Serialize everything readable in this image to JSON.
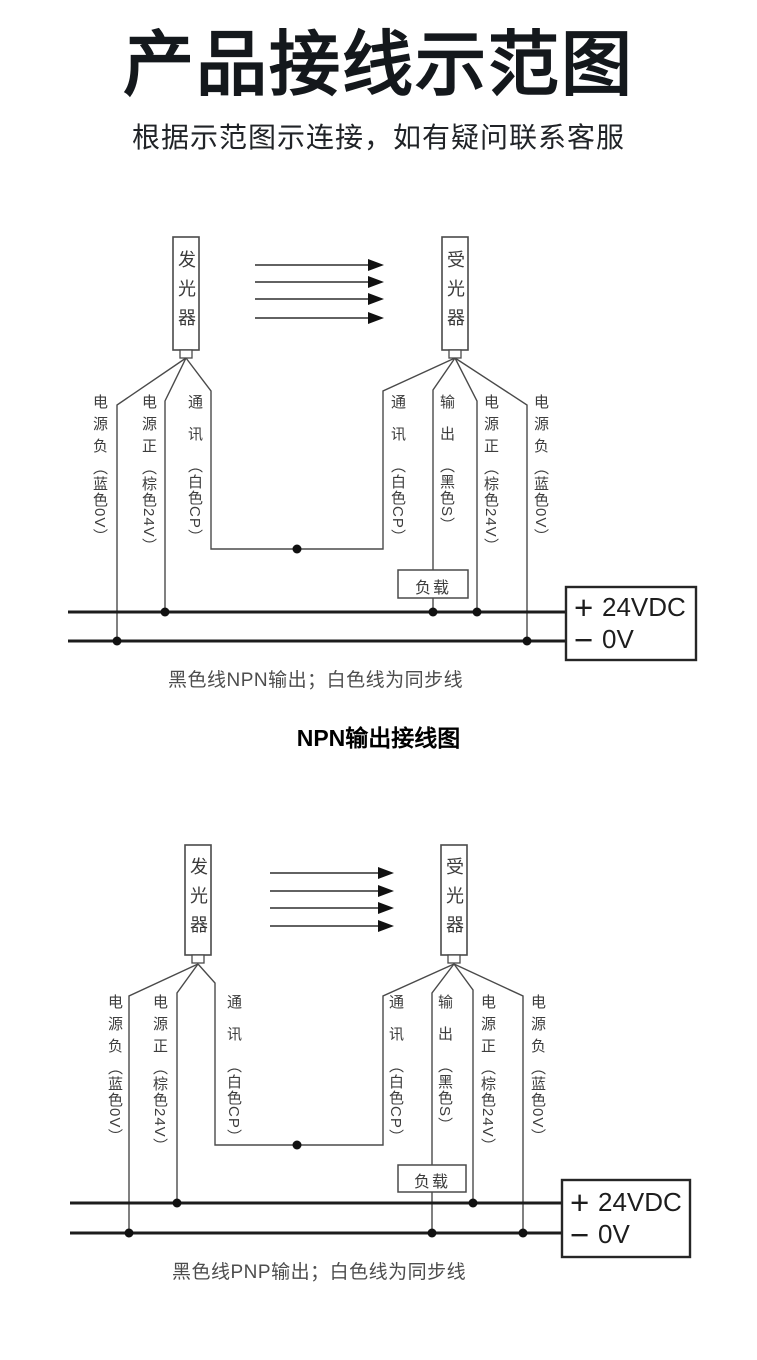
{
  "header": {
    "title": "产品接线示范图",
    "subtitle": "根据示范图示连接，如有疑问联系客服"
  },
  "diagrams": [
    {
      "emitter": "发光器",
      "receiver": "受光器",
      "left_wires": [
        {
          "name": "电源负",
          "detail": "（蓝色0V）"
        },
        {
          "name": "电源正",
          "detail": "（棕色24V）"
        },
        {
          "name": "通讯",
          "detail": "（白色CP）"
        }
      ],
      "right_wires": [
        {
          "name": "通讯",
          "detail": "（白色CP）"
        },
        {
          "name": "输出",
          "detail": "（黑色S）"
        },
        {
          "name": "电源正",
          "detail": "（棕色24V）"
        },
        {
          "name": "电源负",
          "detail": "（蓝色0V）"
        }
      ],
      "load": "负载",
      "psu": {
        "positive_sign": "+",
        "positive_label": "24VDC",
        "negative_sign": "−",
        "negative_label": "0V"
      },
      "caption": "黑色线NPN输出；白色线为同步线",
      "title": "NPN输出接线图"
    },
    {
      "emitter": "发光器",
      "receiver": "受光器",
      "left_wires": [
        {
          "name": "电源负",
          "detail": "（蓝色0V）"
        },
        {
          "name": "电源正",
          "detail": "（棕色24V）"
        },
        {
          "name": "通讯",
          "detail": "（白色CP）"
        }
      ],
      "right_wires": [
        {
          "name": "通讯",
          "detail": "（白色CP）"
        },
        {
          "name": "输出",
          "detail": "（黑色S）"
        },
        {
          "name": "电源正",
          "detail": "（棕色24V）"
        },
        {
          "name": "电源负",
          "detail": "（蓝色0V）"
        }
      ],
      "load": "负载",
      "psu": {
        "positive_sign": "+",
        "positive_label": "24VDC",
        "negative_sign": "−",
        "negative_label": "0V"
      },
      "caption": "黑色线PNP输出；白色线为同步线"
    }
  ]
}
